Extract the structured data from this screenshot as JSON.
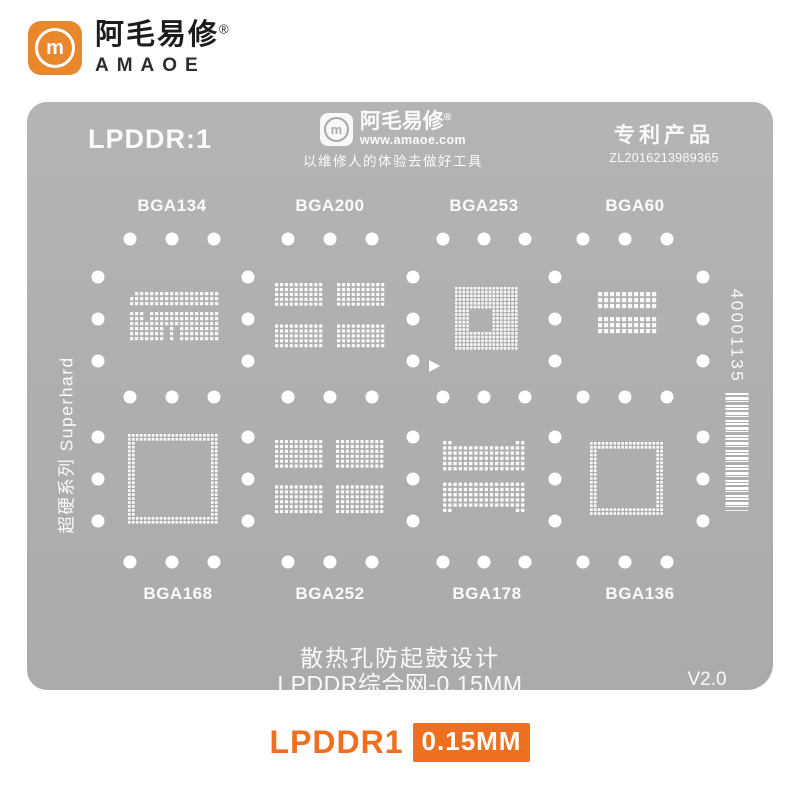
{
  "brand": {
    "cn": "阿毛易修",
    "reg": "®",
    "en": "AMAOE",
    "monogram": "m"
  },
  "plate": {
    "model": "LPDDR:1",
    "logo": {
      "cn": "阿毛易修",
      "reg": "®",
      "url": "www.amaoe.com",
      "slogan": "以维修人的体验去做好工具",
      "monogram": "m"
    },
    "patent": {
      "title": "专利产品",
      "number": "ZL2016213989365"
    },
    "left_side": "超硬系列 Superhard",
    "serial": "40001135",
    "note1": "散热孔防起鼓设计",
    "note2": "LPDDR综合网-0.15MM",
    "version": "V2.0"
  },
  "caption": {
    "model": "LPDDR1",
    "thickness": "0.15MM"
  },
  "colors": {
    "brand_orange": "#E8872B",
    "accent_orange": "#ED6F1F",
    "plate_gray": "#AEAEAE",
    "ink_white": "#FAFAFA"
  },
  "stencil": {
    "holes": {
      "r": 6.5,
      "rows_y": [
        239,
        397,
        562
      ],
      "rows_x": [
        130,
        172,
        214,
        288,
        330,
        372,
        443,
        484,
        525,
        583,
        625,
        667
      ],
      "cols_x": [
        98,
        248,
        413,
        555,
        703
      ],
      "cols_y": [
        277,
        319,
        361,
        437,
        479,
        521
      ]
    },
    "triangle_marker": {
      "points": "429,360 429,372 440,366"
    },
    "footprints": [
      {
        "label": "BGA134",
        "label_x": 172,
        "label_y": 206,
        "type": "bitmap",
        "x": 130,
        "y": 292,
        "pitch": 5,
        "dot": 3.3,
        "bitmap": [
          "011111111111111111",
          "111111111111111111",
          "111111111111111111",
          "000000000000000000",
          "111011111111111111",
          "111011111111111111",
          "111111111111111111",
          "111111101011111111",
          "111111101011111111",
          "111111101011111111"
        ]
      },
      {
        "label": "BGA200",
        "label_x": 330,
        "label_y": 206,
        "type": "blocks",
        "x": 275,
        "y": 283,
        "cols": 10,
        "rows": 5,
        "pitch": 4.9,
        "dot": 3.2,
        "gap_x": 13,
        "gap_y": 17,
        "nx": 2,
        "ny": 2
      },
      {
        "label": "BGA253",
        "label_x": 484,
        "label_y": 206,
        "type": "grid-hole",
        "x": 455,
        "y": 287,
        "n": 17,
        "pitch": 3.75,
        "dot": 2.6,
        "hole": {
          "c0": 4,
          "r0": 6,
          "w": 6,
          "h": 6
        }
      },
      {
        "label": "BGA60",
        "label_x": 635,
        "label_y": 206,
        "type": "blocks",
        "x": 598,
        "y": 292,
        "cols": 10,
        "rows": 3,
        "pitch": 6,
        "dot": 4.2,
        "gap_x": 0,
        "gap_y": 7,
        "nx": 1,
        "ny": 2
      },
      {
        "label": "BGA168",
        "label_x": 178,
        "label_y": 594,
        "type": "ring",
        "x": 128,
        "y": 434,
        "n": 23,
        "pitch": 3.95,
        "dot": 2.7,
        "thick": 2
      },
      {
        "label": "BGA252",
        "label_x": 330,
        "label_y": 594,
        "type": "blocks",
        "x": 275,
        "y": 440,
        "cols": 10,
        "rows": 6,
        "pitch": 4.9,
        "dot": 3.2,
        "gap_x": 12,
        "gap_y": 16,
        "nx": 2,
        "ny": 2
      },
      {
        "label": "BGA178",
        "label_x": 487,
        "label_y": 594,
        "type": "bitmap",
        "x": 443,
        "y": 441,
        "pitch": 5.2,
        "dot": 3.4,
        "bitmap": [
          "1100000000000011",
          "1111111111111111",
          "1111111111111111",
          "1111111111111111",
          "1111111111111111",
          "1111111111111111",
          "0000000000000000",
          "0000000000000000",
          "1111111111111111",
          "1111111111111111",
          "1111111111111111",
          "1111111111111111",
          "1111111111111111",
          "1100000000000011"
        ]
      },
      {
        "label": "BGA136",
        "label_x": 640,
        "label_y": 594,
        "type": "ring",
        "x": 590,
        "y": 442,
        "n": 19,
        "pitch": 3.9,
        "dot": 2.7,
        "thick": 2
      }
    ]
  }
}
